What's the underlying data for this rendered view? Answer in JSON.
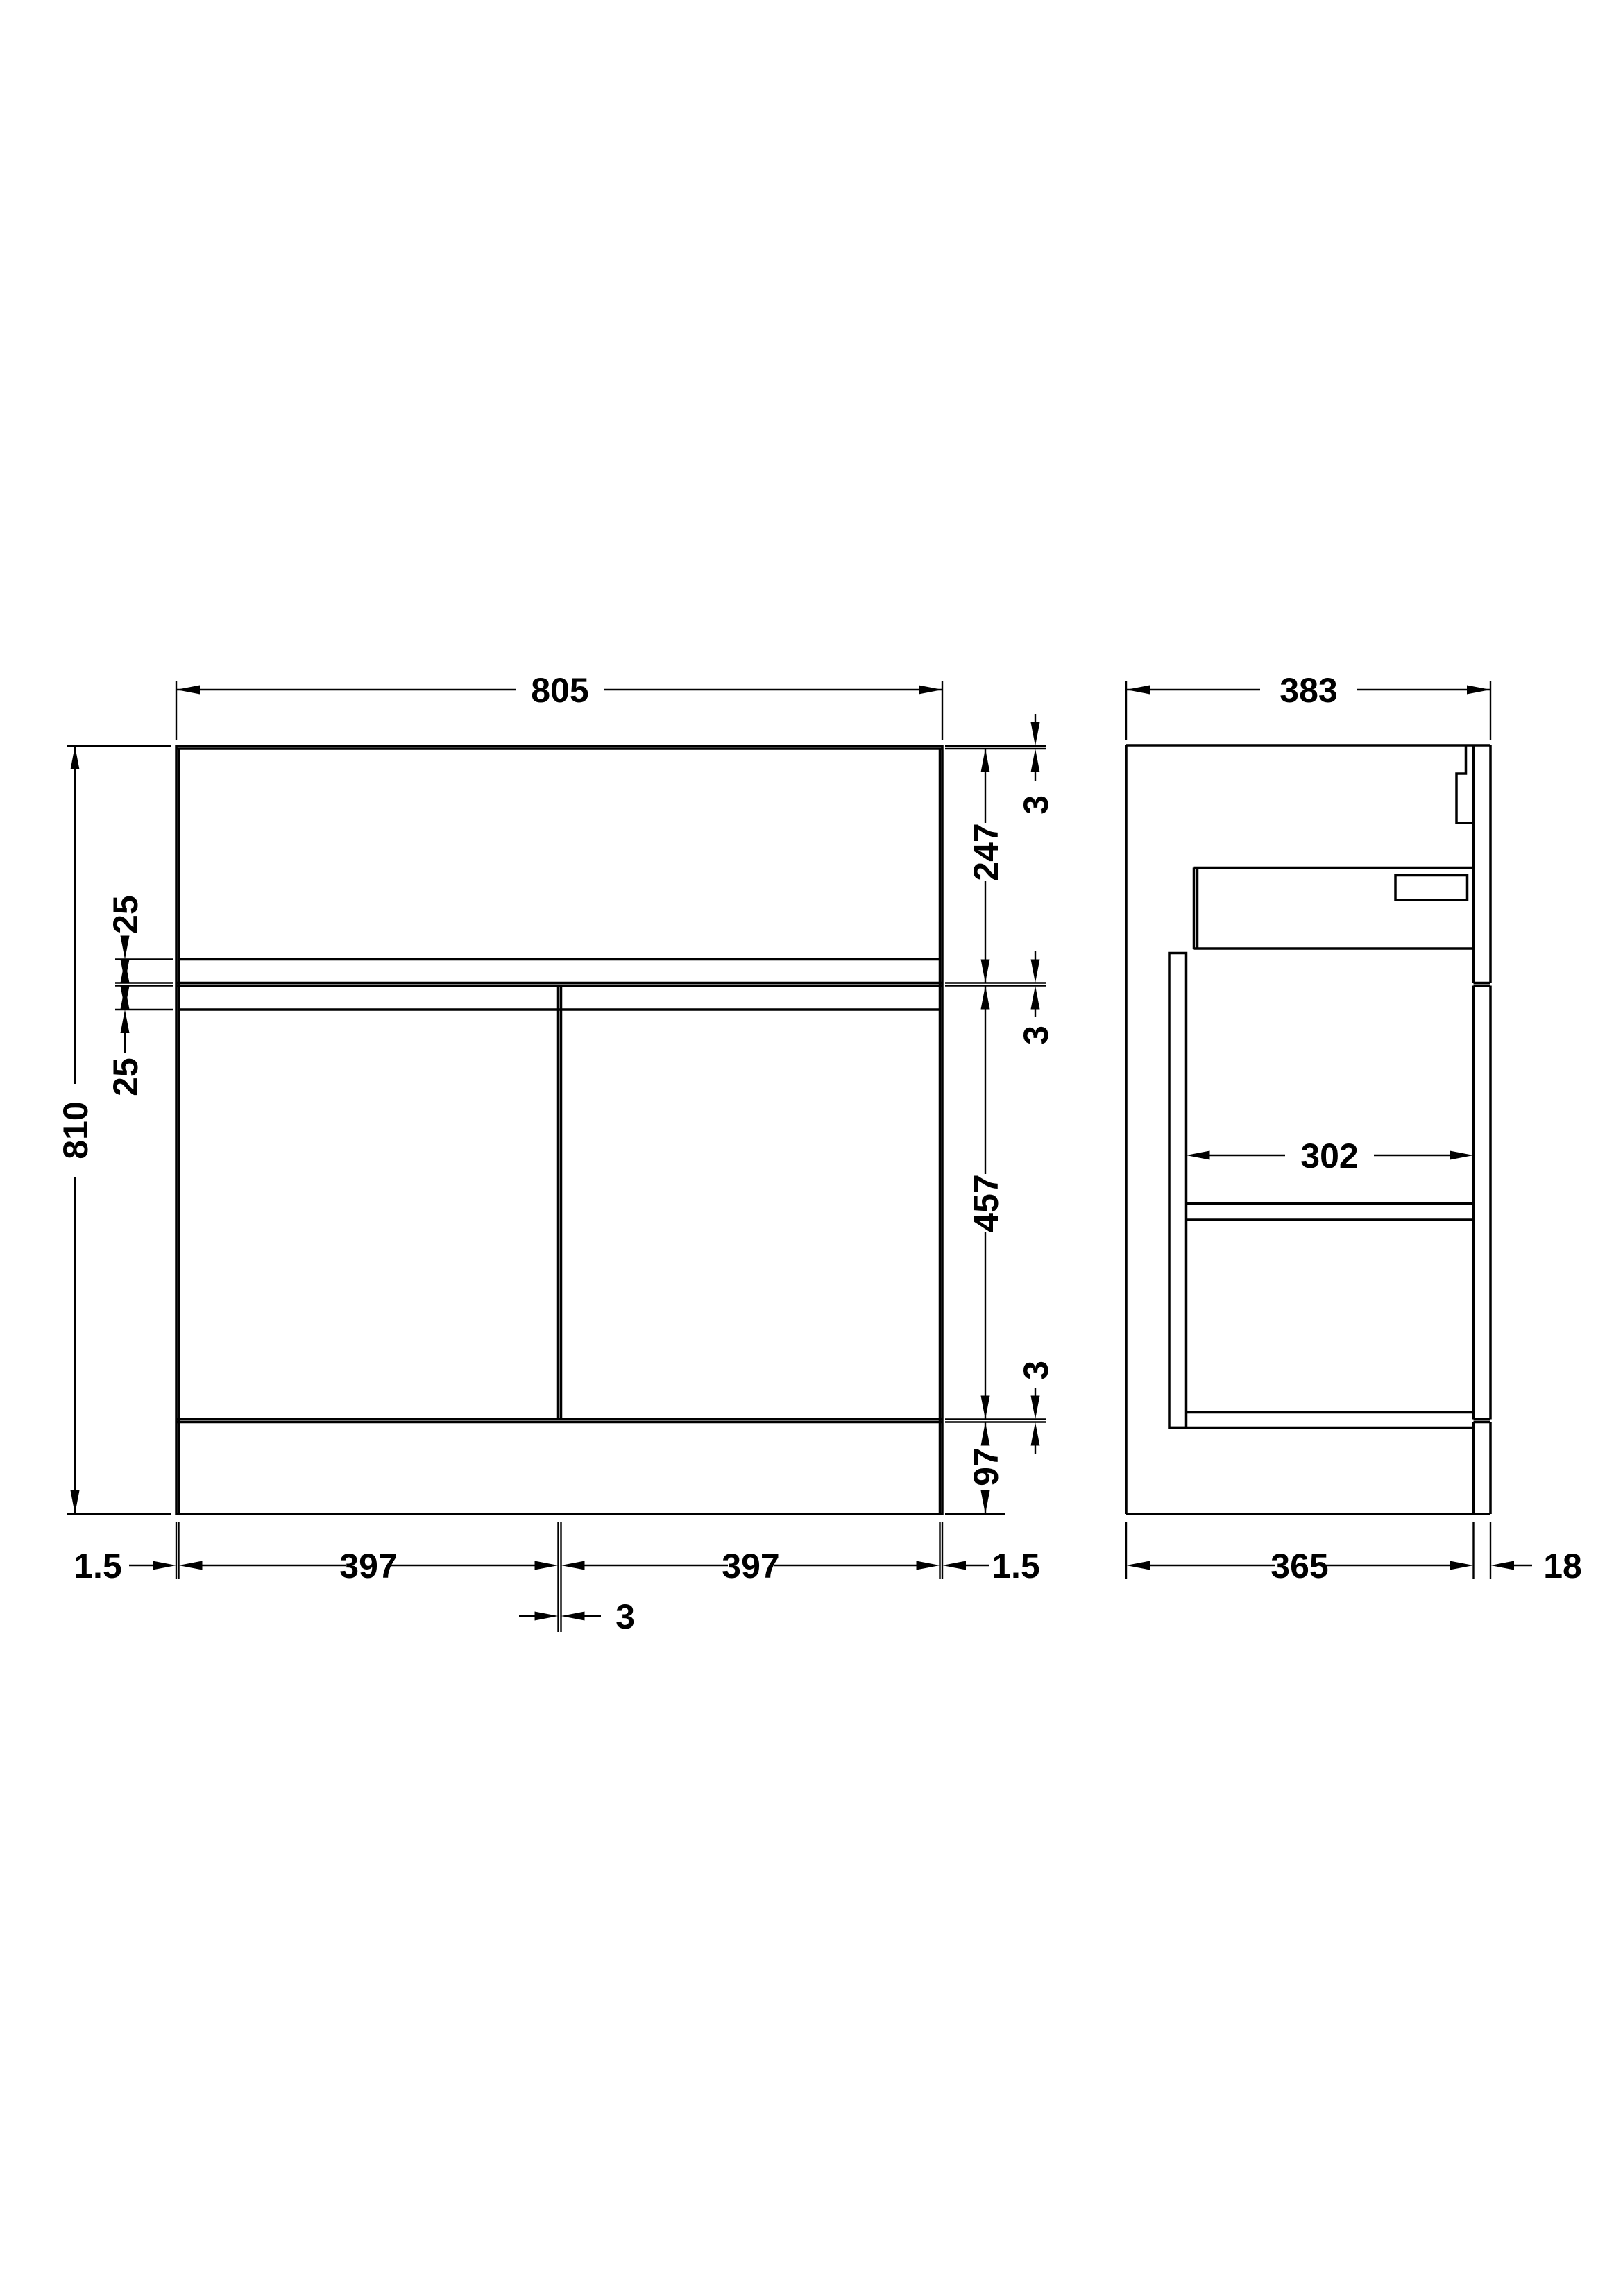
{
  "drawing": {
    "type": "technical-dimension-drawing",
    "units": "mm",
    "line_color": "#000000",
    "background_color": "#ffffff",
    "front_view": {
      "overall_width": "805",
      "overall_height": "810",
      "worktop_edge_thickness": "3",
      "upper_panel_height": "247",
      "upper_joint_gap": "3",
      "door_height": "457",
      "lower_joint_gap": "3",
      "plinth_height": "97",
      "groove_above_joint": "25",
      "groove_below_joint": "25",
      "left_side_gap": "1.5",
      "left_door_width": "397",
      "center_door_gap": "3",
      "right_door_width": "397",
      "right_side_gap": "1.5"
    },
    "side_view": {
      "overall_depth": "383",
      "internal_depth": "302",
      "carcass_depth": "365",
      "panel_thickness": "18"
    }
  }
}
